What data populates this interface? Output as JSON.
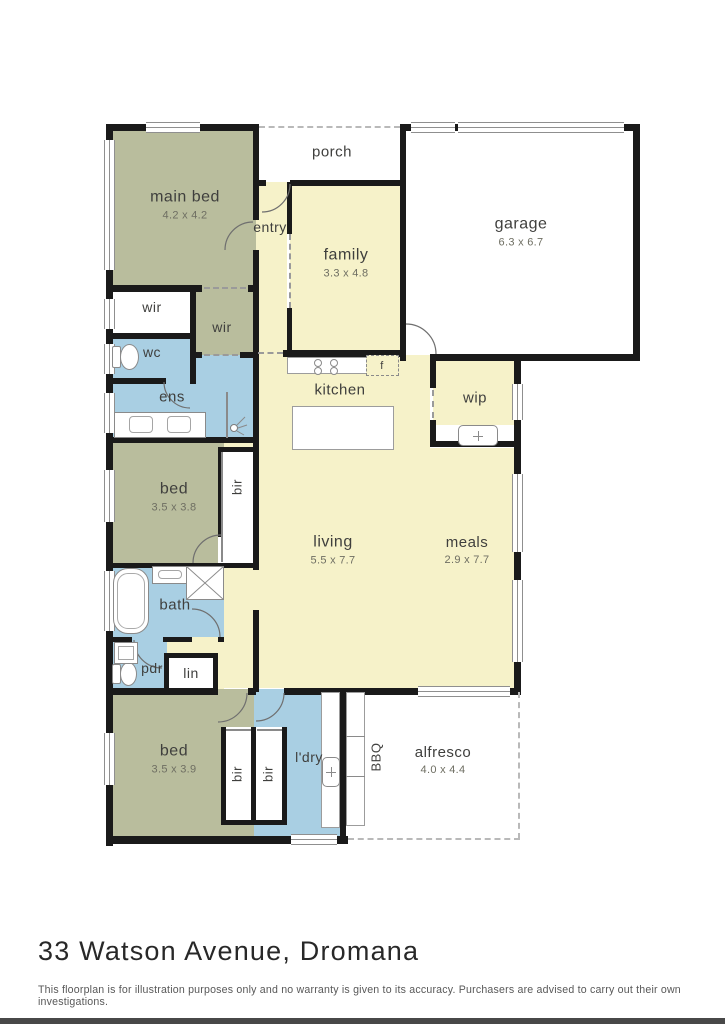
{
  "page": {
    "title": "33 Watson Avenue, Dromana",
    "disclaimer": "This floorplan is for illustration purposes only and no warranty is given to its accuracy. Purchasers are advised to carry out their own investigations."
  },
  "colors": {
    "wall": "#1a1a1a",
    "olive": "#b9bd9d",
    "yellow": "#f6f2c9",
    "blue": "#a9cfe3",
    "white": "#ffffff",
    "label": "#3f3f3d",
    "dim_text": "#6e6e62",
    "fixture": "#8a8a8a"
  },
  "floorplan": {
    "rooms": [
      {
        "name": "porch",
        "fill": "white",
        "x": 258,
        "y": 127,
        "w": 145,
        "h": 53
      },
      {
        "name": "garage",
        "fill": "white",
        "x": 403,
        "y": 127,
        "w": 234,
        "h": 228
      },
      {
        "name": "main-bed",
        "fill": "olive",
        "x": 112,
        "y": 127,
        "w": 146,
        "h": 162
      },
      {
        "name": "entry-hall",
        "fill": "yellow",
        "x": 256,
        "y": 182,
        "w": 31,
        "h": 173
      },
      {
        "name": "family",
        "fill": "yellow",
        "x": 290,
        "y": 182,
        "w": 110,
        "h": 168
      },
      {
        "name": "wc-ens",
        "fill": "blue",
        "x": 112,
        "y": 333,
        "w": 141,
        "h": 104
      },
      {
        "name": "wir-robe",
        "fill": "olive",
        "x": 196,
        "y": 289,
        "w": 60,
        "h": 66
      },
      {
        "name": "wir-left",
        "fill": "white",
        "x": 112,
        "y": 289,
        "w": 80,
        "h": 44
      },
      {
        "name": "kitchen-living",
        "fill": "yellow",
        "x": 256,
        "y": 355,
        "w": 174,
        "h": 333
      },
      {
        "name": "wip",
        "fill": "yellow",
        "x": 433,
        "y": 355,
        "w": 81,
        "h": 70
      },
      {
        "name": "wip-alcove",
        "fill": "white",
        "x": 436,
        "y": 425,
        "w": 78,
        "h": 22
      },
      {
        "name": "meals",
        "fill": "yellow",
        "x": 430,
        "y": 448,
        "w": 84,
        "h": 240
      },
      {
        "name": "hall-mid",
        "fill": "yellow",
        "x": 224,
        "y": 442,
        "w": 32,
        "h": 246
      },
      {
        "name": "bed-mid",
        "fill": "olive",
        "x": 112,
        "y": 442,
        "w": 112,
        "h": 121
      },
      {
        "name": "bir-mid",
        "fill": "white",
        "x": 218,
        "y": 447,
        "w": 38,
        "h": 118
      },
      {
        "name": "bath",
        "fill": "blue",
        "x": 112,
        "y": 563,
        "w": 112,
        "h": 74
      },
      {
        "name": "hall-lin",
        "fill": "yellow",
        "x": 164,
        "y": 637,
        "w": 60,
        "h": 52
      },
      {
        "name": "pdr",
        "fill": "blue",
        "x": 112,
        "y": 637,
        "w": 55,
        "h": 52
      },
      {
        "name": "lin",
        "fill": "white",
        "x": 164,
        "y": 653,
        "w": 54,
        "h": 36
      },
      {
        "name": "bed-lower",
        "fill": "olive",
        "x": 112,
        "y": 689,
        "w": 142,
        "h": 147
      },
      {
        "name": "laundry",
        "fill": "blue",
        "x": 254,
        "y": 689,
        "w": 88,
        "h": 147
      },
      {
        "name": "bir-lower-1",
        "fill": "white",
        "x": 221,
        "y": 727,
        "w": 33,
        "h": 96
      },
      {
        "name": "bir-lower-2",
        "fill": "white",
        "x": 254,
        "y": 727,
        "w": 33,
        "h": 96
      },
      {
        "name": "alfresco",
        "fill": "white",
        "x": 348,
        "y": 692,
        "w": 171,
        "h": 146
      }
    ],
    "walls": [
      [
        106,
        124,
        7,
        722
      ],
      [
        106,
        124,
        153,
        7
      ],
      [
        400,
        124,
        240,
        7
      ],
      [
        400,
        124,
        6,
        237
      ],
      [
        633,
        124,
        7,
        237
      ],
      [
        436,
        354,
        204,
        7
      ],
      [
        253,
        124,
        6,
        96
      ],
      [
        253,
        250,
        6,
        42
      ],
      [
        256,
        180,
        10,
        6
      ],
      [
        290,
        180,
        113,
        6
      ],
      [
        287,
        182,
        5,
        52
      ],
      [
        287,
        308,
        5,
        47
      ],
      [
        106,
        285,
        96,
        7
      ],
      [
        248,
        285,
        11,
        7
      ],
      [
        190,
        285,
        6,
        99
      ],
      [
        106,
        333,
        90,
        6
      ],
      [
        106,
        378,
        60,
        6
      ],
      [
        190,
        352,
        12,
        6
      ],
      [
        240,
        352,
        19,
        6
      ],
      [
        253,
        292,
        6,
        150
      ],
      [
        106,
        437,
        153,
        6
      ],
      [
        283,
        350,
        120,
        7
      ],
      [
        430,
        354,
        6,
        34
      ],
      [
        430,
        420,
        6,
        27
      ],
      [
        430,
        441,
        90,
        6
      ],
      [
        514,
        354,
        7,
        30
      ],
      [
        514,
        420,
        7,
        34
      ],
      [
        514,
        452,
        7,
        22
      ],
      [
        514,
        552,
        7,
        28
      ],
      [
        514,
        662,
        7,
        33
      ],
      [
        340,
        688,
        82,
        7
      ],
      [
        508,
        688,
        13,
        7
      ],
      [
        253,
        437,
        6,
        133
      ],
      [
        253,
        610,
        6,
        82
      ],
      [
        218,
        447,
        38,
        5
      ],
      [
        218,
        447,
        5,
        90
      ],
      [
        218,
        563,
        38,
        5
      ],
      [
        106,
        563,
        120,
        5
      ],
      [
        106,
        637,
        26,
        5
      ],
      [
        163,
        637,
        29,
        5
      ],
      [
        218,
        637,
        6,
        5
      ],
      [
        164,
        653,
        54,
        5
      ],
      [
        164,
        653,
        5,
        38
      ],
      [
        213,
        653,
        5,
        38
      ],
      [
        106,
        688,
        112,
        7
      ],
      [
        248,
        688,
        8,
        7
      ],
      [
        284,
        688,
        60,
        7
      ],
      [
        106,
        836,
        242,
        8
      ],
      [
        340,
        688,
        6,
        156
      ],
      [
        221,
        727,
        5,
        98
      ],
      [
        251,
        727,
        5,
        98
      ],
      [
        282,
        727,
        5,
        98
      ],
      [
        221,
        820,
        66,
        5
      ]
    ],
    "windows": [
      [
        104,
        140,
        11,
        130
      ],
      [
        104,
        299,
        11,
        30
      ],
      [
        104,
        344,
        11,
        30
      ],
      [
        104,
        393,
        11,
        40
      ],
      [
        104,
        470,
        11,
        52
      ],
      [
        104,
        571,
        11,
        60
      ],
      [
        104,
        733,
        11,
        52
      ],
      [
        146,
        122,
        54,
        11
      ],
      [
        411,
        122,
        44,
        11
      ],
      [
        458,
        122,
        166,
        11
      ],
      [
        512,
        384,
        11,
        36
      ],
      [
        512,
        474,
        11,
        78
      ],
      [
        512,
        580,
        11,
        82
      ],
      [
        418,
        686,
        92,
        11
      ],
      [
        291,
        834,
        46,
        11
      ]
    ],
    "dashes": [
      {
        "o": "h",
        "x": 259,
        "y": 126,
        "len": 141,
        "light": true
      },
      {
        "o": "v",
        "x": 289,
        "y": 234,
        "len": 74,
        "light": false
      },
      {
        "o": "h",
        "x": 258,
        "y": 352,
        "len": 25,
        "light": false
      },
      {
        "o": "h",
        "x": 204,
        "y": 287,
        "len": 42,
        "light": false
      },
      {
        "o": "h",
        "x": 204,
        "y": 354,
        "len": 34,
        "light": false
      },
      {
        "o": "v",
        "x": 432,
        "y": 390,
        "len": 28,
        "light": false
      },
      {
        "o": "v",
        "x": 518,
        "y": 692,
        "len": 147,
        "light": true
      },
      {
        "o": "h",
        "x": 348,
        "y": 838,
        "len": 172,
        "light": true
      }
    ],
    "doors": [
      {
        "x": 262,
        "y": 184,
        "s": 28,
        "o": "tl"
      },
      {
        "x": 225,
        "y": 222,
        "s": 28,
        "o": "br"
      },
      {
        "x": 406,
        "y": 324,
        "s": 30,
        "o": "bl"
      },
      {
        "x": 164,
        "y": 382,
        "s": 26,
        "o": "tr"
      },
      {
        "x": 192,
        "y": 609,
        "s": 28,
        "o": "bl"
      },
      {
        "x": 134,
        "y": 640,
        "s": 28,
        "o": "tr"
      },
      {
        "x": 193,
        "y": 535,
        "s": 28,
        "o": "br"
      },
      {
        "x": 218,
        "y": 693,
        "s": 29,
        "o": "tl"
      },
      {
        "x": 256,
        "y": 693,
        "s": 28,
        "o": "tl"
      }
    ],
    "fixtures": [
      {
        "t": "toilet",
        "x": 112,
        "y": 342,
        "w": 30,
        "h": 30
      },
      {
        "t": "toilet",
        "x": 112,
        "y": 660,
        "w": 28,
        "h": 28
      },
      {
        "t": "vanity",
        "x": 114,
        "y": 412,
        "w": 92,
        "h": 26,
        "basins": 2
      },
      {
        "t": "line",
        "x": 226,
        "y": 392,
        "w": 2,
        "h": 46
      },
      {
        "t": "showerhead",
        "x": 228,
        "y": 416,
        "s": 20
      },
      {
        "t": "tub",
        "x": 113,
        "y": 568,
        "w": 36,
        "h": 66
      },
      {
        "t": "vanity",
        "x": 152,
        "y": 566,
        "w": 36,
        "h": 18,
        "basins": 1
      },
      {
        "t": "showerx",
        "x": 186,
        "y": 566,
        "w": 38,
        "h": 34
      },
      {
        "t": "sinkbox",
        "x": 114,
        "y": 642,
        "w": 24,
        "h": 22
      },
      {
        "t": "counter",
        "x": 287,
        "y": 357,
        "w": 111,
        "h": 17
      },
      {
        "t": "cooktop",
        "x": 310,
        "y": 358,
        "w": 38,
        "h": 16
      },
      {
        "t": "fbox",
        "x": 366,
        "y": 355,
        "w": 33,
        "h": 21
      },
      {
        "t": "island",
        "x": 292,
        "y": 406,
        "w": 102,
        "h": 44
      },
      {
        "t": "sinktub",
        "x": 458,
        "y": 425,
        "w": 40,
        "h": 21
      },
      {
        "t": "counter",
        "x": 321,
        "y": 692,
        "w": 19,
        "h": 136
      },
      {
        "t": "sinktub",
        "x": 322,
        "y": 757,
        "w": 18,
        "h": 30
      },
      {
        "t": "counter",
        "x": 346,
        "y": 692,
        "w": 19,
        "h": 134
      },
      {
        "t": "line",
        "x": 346,
        "y": 736,
        "w": 19,
        "h": 1
      },
      {
        "t": "line",
        "x": 346,
        "y": 776,
        "w": 19,
        "h": 1
      },
      {
        "t": "line",
        "x": 221,
        "y": 452,
        "w": 2,
        "h": 110
      },
      {
        "t": "line",
        "x": 226,
        "y": 729,
        "w": 25,
        "h": 2
      },
      {
        "t": "line",
        "x": 257,
        "y": 729,
        "w": 25,
        "h": 2
      }
    ],
    "labels": [
      {
        "text": "main bed",
        "dim": "4.2 x 4.2",
        "x": 185,
        "y": 205,
        "size": 16
      },
      {
        "text": "porch",
        "x": 332,
        "y": 152,
        "size": 15
      },
      {
        "text": "entry",
        "x": 270,
        "y": 227,
        "size": 14
      },
      {
        "text": "family",
        "dim": "3.3 x 4.8",
        "x": 346,
        "y": 263,
        "size": 16
      },
      {
        "text": "garage",
        "dim": "6.3 x 6.7",
        "x": 521,
        "y": 232,
        "size": 16
      },
      {
        "text": "wir",
        "x": 152,
        "y": 307,
        "size": 14
      },
      {
        "text": "wir",
        "x": 222,
        "y": 327,
        "size": 14
      },
      {
        "text": "wc",
        "x": 152,
        "y": 352,
        "size": 14
      },
      {
        "text": "ens",
        "x": 172,
        "y": 397,
        "size": 15
      },
      {
        "text": "kitchen",
        "x": 340,
        "y": 390,
        "size": 15
      },
      {
        "text": "wip",
        "x": 475,
        "y": 398,
        "size": 15
      },
      {
        "text": "f",
        "x": 382,
        "y": 366,
        "size": 11
      },
      {
        "text": "bed",
        "dim": "3.5 x 3.8",
        "x": 174,
        "y": 497,
        "size": 16
      },
      {
        "text": "bir",
        "x": 238,
        "y": 487,
        "size": 13,
        "rot": -90
      },
      {
        "text": "living",
        "dim": "5.5 x 7.7",
        "x": 333,
        "y": 550,
        "size": 16
      },
      {
        "text": "meals",
        "dim": "2.9 x 7.7",
        "x": 467,
        "y": 550,
        "size": 15
      },
      {
        "text": "bath",
        "x": 175,
        "y": 605,
        "size": 15
      },
      {
        "text": "pdr",
        "x": 152,
        "y": 668,
        "size": 14
      },
      {
        "text": "lin",
        "x": 191,
        "y": 673,
        "size": 14
      },
      {
        "text": "bed",
        "dim": "3.5 x 3.9",
        "x": 174,
        "y": 759,
        "size": 16
      },
      {
        "text": "bir",
        "x": 238,
        "y": 774,
        "size": 13,
        "rot": -90
      },
      {
        "text": "bir",
        "x": 269,
        "y": 774,
        "size": 13,
        "rot": -90
      },
      {
        "text": "l'dry",
        "x": 309,
        "y": 757,
        "size": 14
      },
      {
        "text": "BBQ",
        "x": 377,
        "y": 757,
        "size": 13,
        "rot": -90
      },
      {
        "text": "alfresco",
        "dim": "4.0 x 4.4",
        "x": 443,
        "y": 760,
        "size": 15
      }
    ]
  }
}
